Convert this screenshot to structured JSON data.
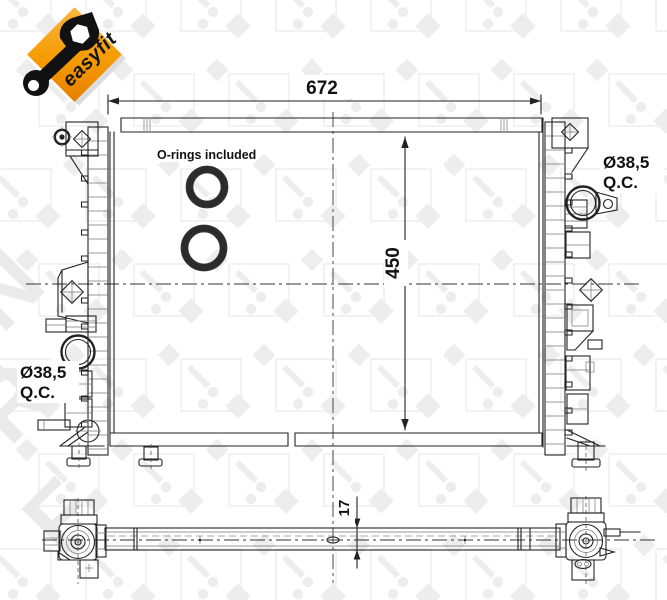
{
  "logo": {
    "text": "easyfit"
  },
  "watermark": {
    "letters": [
      "N",
      "R",
      "F"
    ]
  },
  "front_view": {
    "width_label": "672",
    "height_label": "450",
    "orings_note": "O-rings included",
    "left_port": {
      "diameter": "Ø38,5",
      "type": "Q.C."
    },
    "right_port": {
      "diameter": "Ø38,5",
      "type": "Q.C."
    }
  },
  "bottom_view": {
    "thickness_label": "17"
  },
  "colors": {
    "accent_orange": "#F59C00",
    "line": "#1F1F1F",
    "watermark_gray": "#EDEDED"
  }
}
